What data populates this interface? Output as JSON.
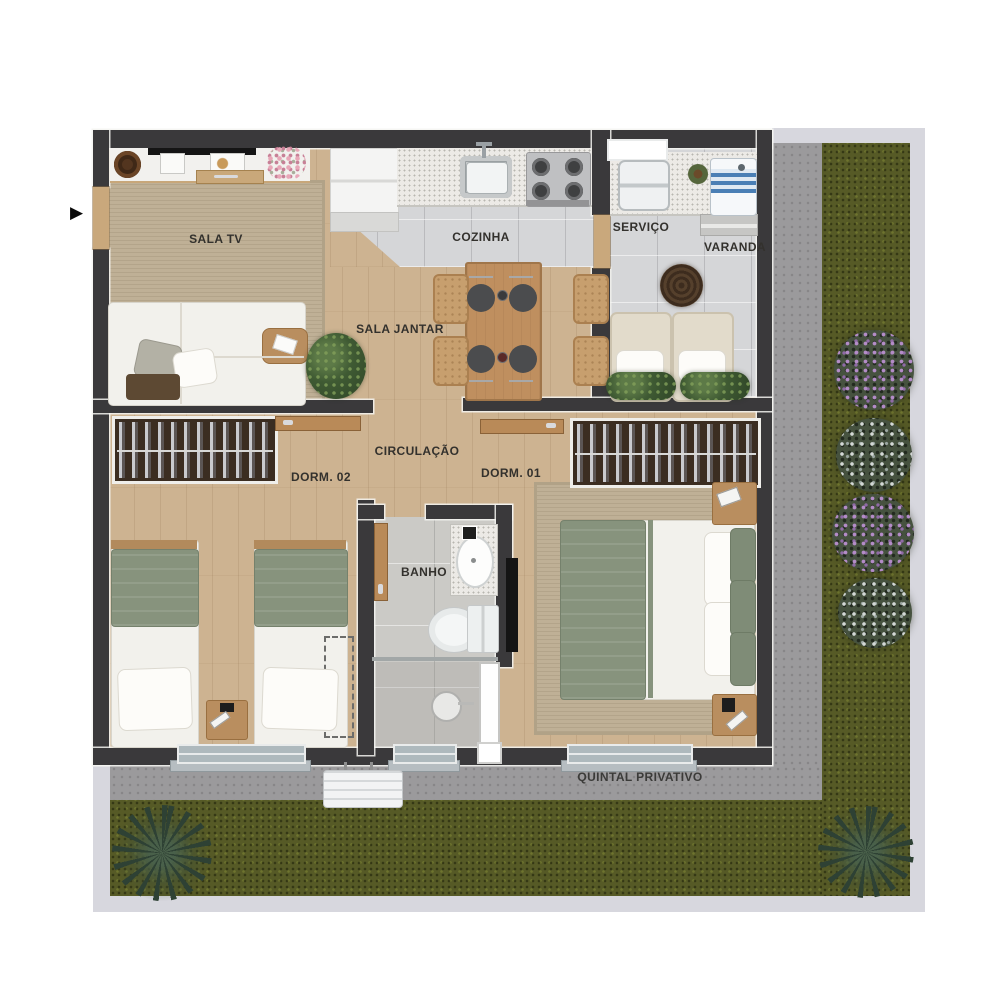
{
  "rooms": [
    {
      "name": "sala-tv",
      "label": "SALA TV"
    },
    {
      "name": "cozinha",
      "label": "COZINHA"
    },
    {
      "name": "servico",
      "label": "SERVIÇO"
    },
    {
      "name": "varanda",
      "label": "VARANDA"
    },
    {
      "name": "sala-jantar",
      "label": "SALA JANTAR"
    },
    {
      "name": "circulacao",
      "label": "CIRCULAÇÃO"
    },
    {
      "name": "dorm-02",
      "label": "DORM. 02"
    },
    {
      "name": "dorm-01",
      "label": "DORM. 01"
    },
    {
      "name": "banho",
      "label": "BANHO"
    },
    {
      "name": "quintal",
      "label": "QUINTAL PRIVATIVO"
    }
  ],
  "entrance": {
    "marker": "▶"
  },
  "colors": {
    "wall": "#3a393b",
    "wood_floor": "#cdb391",
    "rug": "#bfb096",
    "kitchen_tile": "#d5d6d8",
    "bath_tile": "#cbcac6",
    "grass": "#565a26",
    "concrete_path": "#9b9a9c",
    "terrain_edge": "#d7d7de",
    "bed_green": "#87937d",
    "wardrobe_brown": "#3b2d21",
    "door_wood": "#b98a58",
    "washer_blue": "#4a7fb5",
    "flower_purple": "#b48cc8",
    "label_text": "#33312d"
  }
}
